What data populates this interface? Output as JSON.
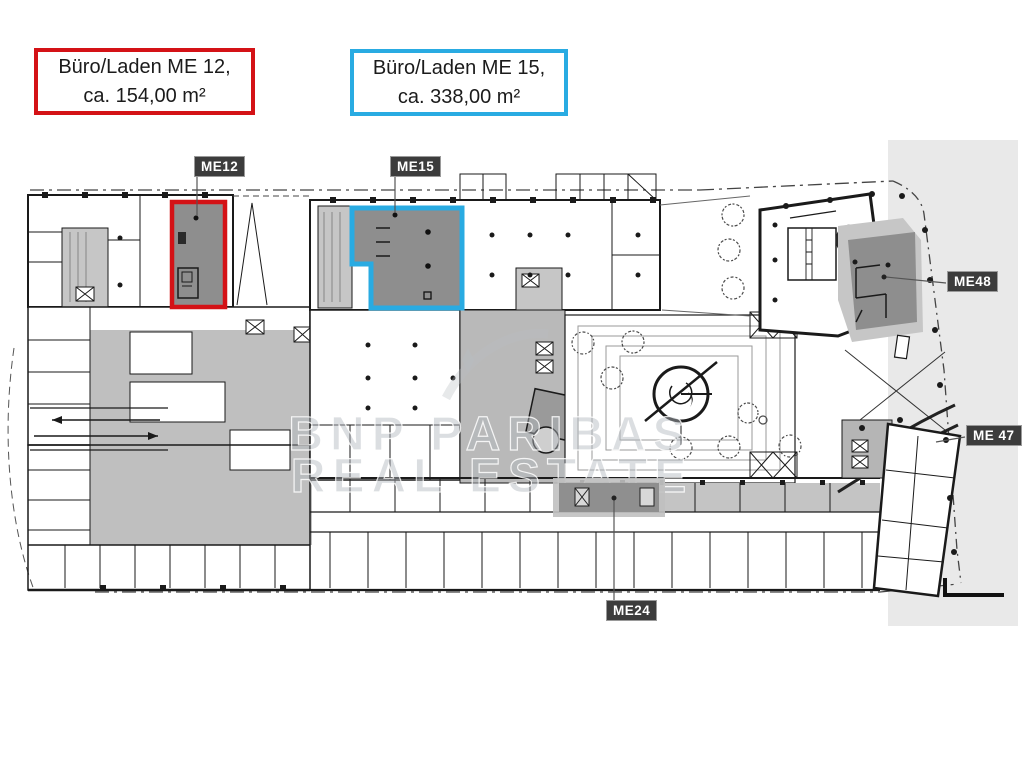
{
  "legend": {
    "me12": {
      "line1": "Büro/Laden ME 12,",
      "line2": "ca. 154,00 m²",
      "border_color": "#d41216"
    },
    "me15": {
      "line1": "Büro/Laden ME 15,",
      "line2": "ca. 338,00 m²",
      "border_color": "#29abe2"
    }
  },
  "badges": [
    {
      "id": "me12",
      "label": "ME12"
    },
    {
      "id": "me15",
      "label": "ME15"
    },
    {
      "id": "me48",
      "label": "ME48"
    },
    {
      "id": "me47",
      "label": "ME 47"
    },
    {
      "id": "me24",
      "label": "ME24"
    }
  ],
  "watermark": {
    "line1": "BNP PARIBAS",
    "line2": "REAL ESTATE"
  },
  "colors": {
    "highlight_red": "#d41216",
    "highlight_blue": "#29abe2",
    "highlight_zone_fill": "#8e8e8e",
    "badge_background": "#3c3c3c",
    "plan_gray_light": "#c6c6c6",
    "plan_gray_mid": "#b9b9b9",
    "right_background_band": "#e9e9e9",
    "watermark_gray": "#b3b8bd",
    "wall_black": "#1a1a1a"
  },
  "highlighted_zones": [
    {
      "id": "me12",
      "type": "rented-unit-outline",
      "outline": "red"
    },
    {
      "id": "me15",
      "type": "rented-unit-outline",
      "outline": "blue"
    },
    {
      "id": "me48",
      "type": "gray-unit"
    },
    {
      "id": "me47",
      "type": "gray-unit"
    },
    {
      "id": "me24",
      "type": "gray-unit"
    }
  ]
}
